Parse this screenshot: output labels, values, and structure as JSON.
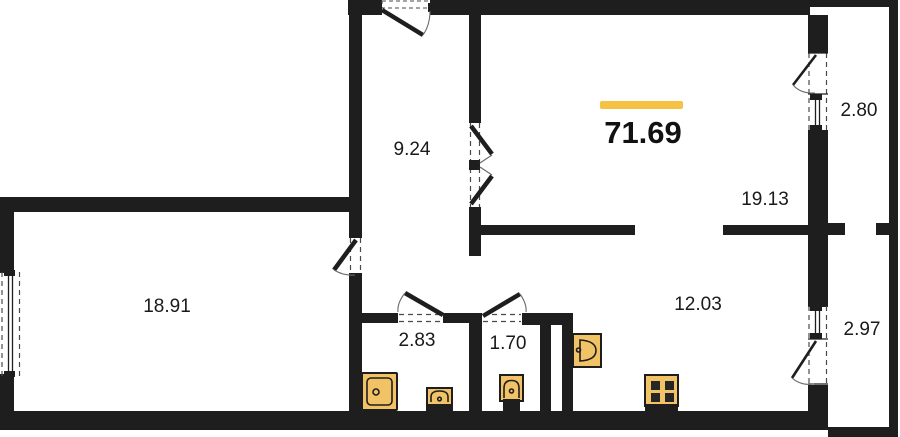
{
  "colors": {
    "wall": "#1e1e1e",
    "accent": "#f6c244",
    "fixture": "#f2c366"
  },
  "total": {
    "area": "71.69"
  },
  "rooms": {
    "hall": {
      "area": "9.24"
    },
    "living_room": {
      "area": "18.91"
    },
    "bedroom": {
      "area": "19.13"
    },
    "kitchen_living": {
      "area": "12.03"
    },
    "bathroom": {
      "area": "2.83"
    },
    "wc": {
      "area": "1.70"
    },
    "balcony_upper": {
      "area": "2.80"
    },
    "balcony_lower": {
      "area": "2.97"
    }
  },
  "fixtures": {
    "bathtub": "bathtub",
    "bathroom_sink": "sink",
    "toilet": "toilet",
    "kitchen_sink": "kitchen-sink",
    "stove": "stove"
  }
}
